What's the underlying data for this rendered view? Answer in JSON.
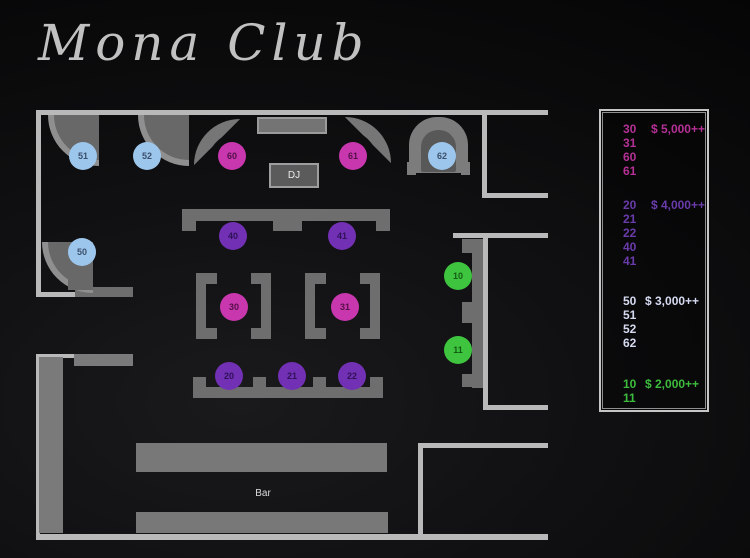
{
  "title": "Mona Club",
  "floor": {
    "dj_label": "DJ",
    "bar_label": "Bar",
    "tables": [
      {
        "label": "10",
        "category": "green"
      },
      {
        "label": "11",
        "category": "green"
      },
      {
        "label": "20",
        "category": "purple"
      },
      {
        "label": "21",
        "category": "purple"
      },
      {
        "label": "22",
        "category": "purple"
      },
      {
        "label": "30",
        "category": "pink"
      },
      {
        "label": "31",
        "category": "pink"
      },
      {
        "label": "40",
        "category": "purple"
      },
      {
        "label": "41",
        "category": "purple"
      },
      {
        "label": "50",
        "category": "blue"
      },
      {
        "label": "51",
        "category": "blue"
      },
      {
        "label": "52",
        "category": "blue"
      },
      {
        "label": "60",
        "category": "pink"
      },
      {
        "label": "61",
        "category": "pink"
      },
      {
        "label": "62",
        "category": "blue"
      }
    ]
  },
  "legend": {
    "groups": [
      {
        "color": "#b53095",
        "rows": [
          {
            "num": "30",
            "price": "$ 5,000++"
          },
          {
            "num": "31"
          },
          {
            "num": "60"
          },
          {
            "num": "61"
          }
        ]
      },
      {
        "color": "#6a3bab",
        "rows": [
          {
            "num": "20",
            "price": "$ 4,000++"
          },
          {
            "num": "21"
          },
          {
            "num": "22"
          },
          {
            "num": "40"
          },
          {
            "num": "41"
          }
        ]
      },
      {
        "color": "#d6daf0",
        "rows": [
          {
            "num": "50",
            "price": "$ 3,000++"
          },
          {
            "num": "51"
          },
          {
            "num": "52"
          },
          {
            "num": "62"
          }
        ]
      },
      {
        "color": "#3dbb3d",
        "rows": [
          {
            "num": "10",
            "price": "$ 2,000++"
          },
          {
            "num": "11"
          }
        ]
      }
    ]
  },
  "colors": {
    "table_pink": "#c837ae",
    "table_purple": "#7230b4",
    "table_blue": "#9dc6ed",
    "table_green": "#3ec43e",
    "wall": "#b9b9b9",
    "bench": "#6e6e6e"
  }
}
